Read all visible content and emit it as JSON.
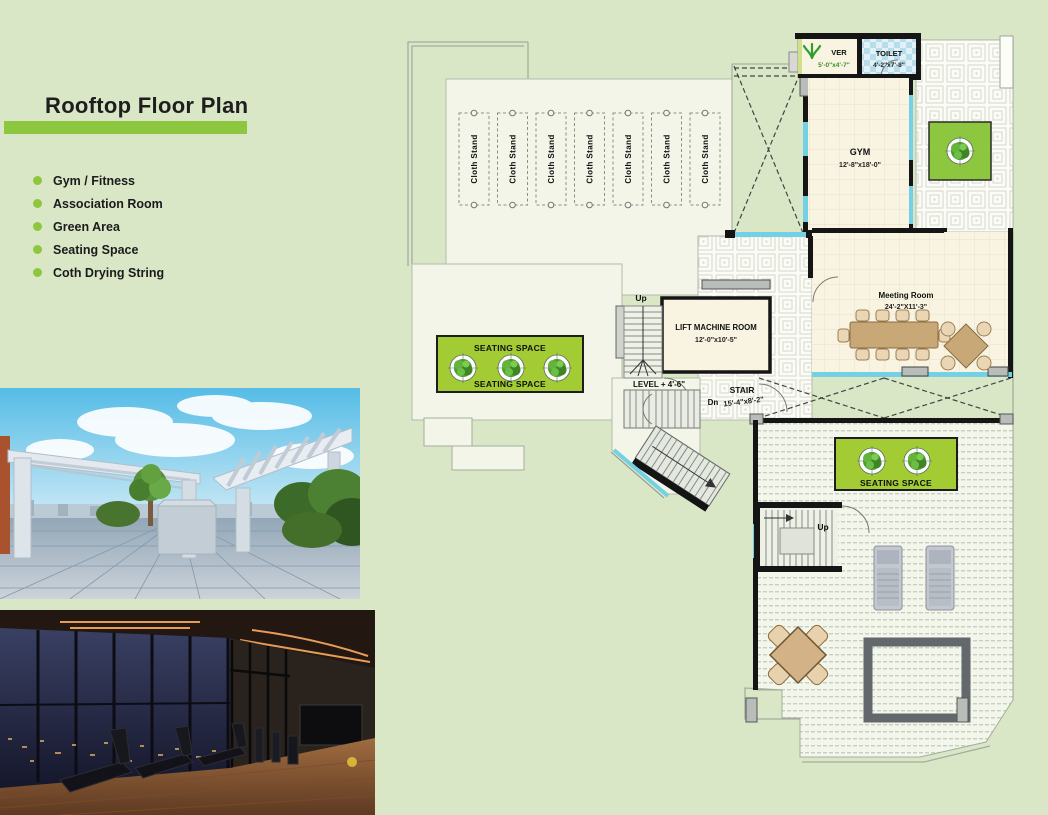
{
  "page": {
    "background": "#d9e7c6"
  },
  "left_panel": {
    "title": "Rooftop Floor Plan",
    "accent_color": "#8dc63f",
    "legend": [
      {
        "label": "Gym / Fitness"
      },
      {
        "label": "Association Room"
      },
      {
        "label": "Green Area"
      },
      {
        "label": "Seating Space"
      },
      {
        "label": "Coth Drying String"
      }
    ],
    "photos": [
      {
        "name": "rooftop-terrace-render"
      },
      {
        "name": "gym-interior-render"
      }
    ]
  },
  "plan": {
    "rooms": {
      "ver": {
        "label": "VER",
        "dims": "5'-0\"x4'-7\""
      },
      "toilet_top": {
        "label": "TOILET",
        "dims": "4'-2\"x7'-8\""
      },
      "gym": {
        "label": "GYM",
        "dims": "12'-8\"x18'-0\""
      },
      "toilet_mid": {
        "label": "TOILET",
        "dims": "7'-0\"x5'-0\""
      },
      "meeting_room": {
        "label": "Meeting Room",
        "dims": "24'-2\"X11'-3\""
      },
      "lift_machine_room": {
        "label": "LIFT MACHINE ROOM",
        "dims": "12'-0\"x10'-5\""
      },
      "stair": {
        "label": "STAIR",
        "dims": "15'-4\"x8'-2\""
      }
    },
    "labels": {
      "up": "Up",
      "dn": "Dn",
      "level": "LEVEL + 4'-6\"",
      "seating_space": "SEATING SPACE",
      "cloth_stand": "Cloth Stand"
    },
    "colors": {
      "wall": "#151515",
      "window_glass": "#74d0e4",
      "room_fill": "#f8f4e1",
      "green_area": "#a3cb33",
      "deck_fill": "#f2f5e8",
      "toilet_floor": "#cfe8f2"
    }
  }
}
